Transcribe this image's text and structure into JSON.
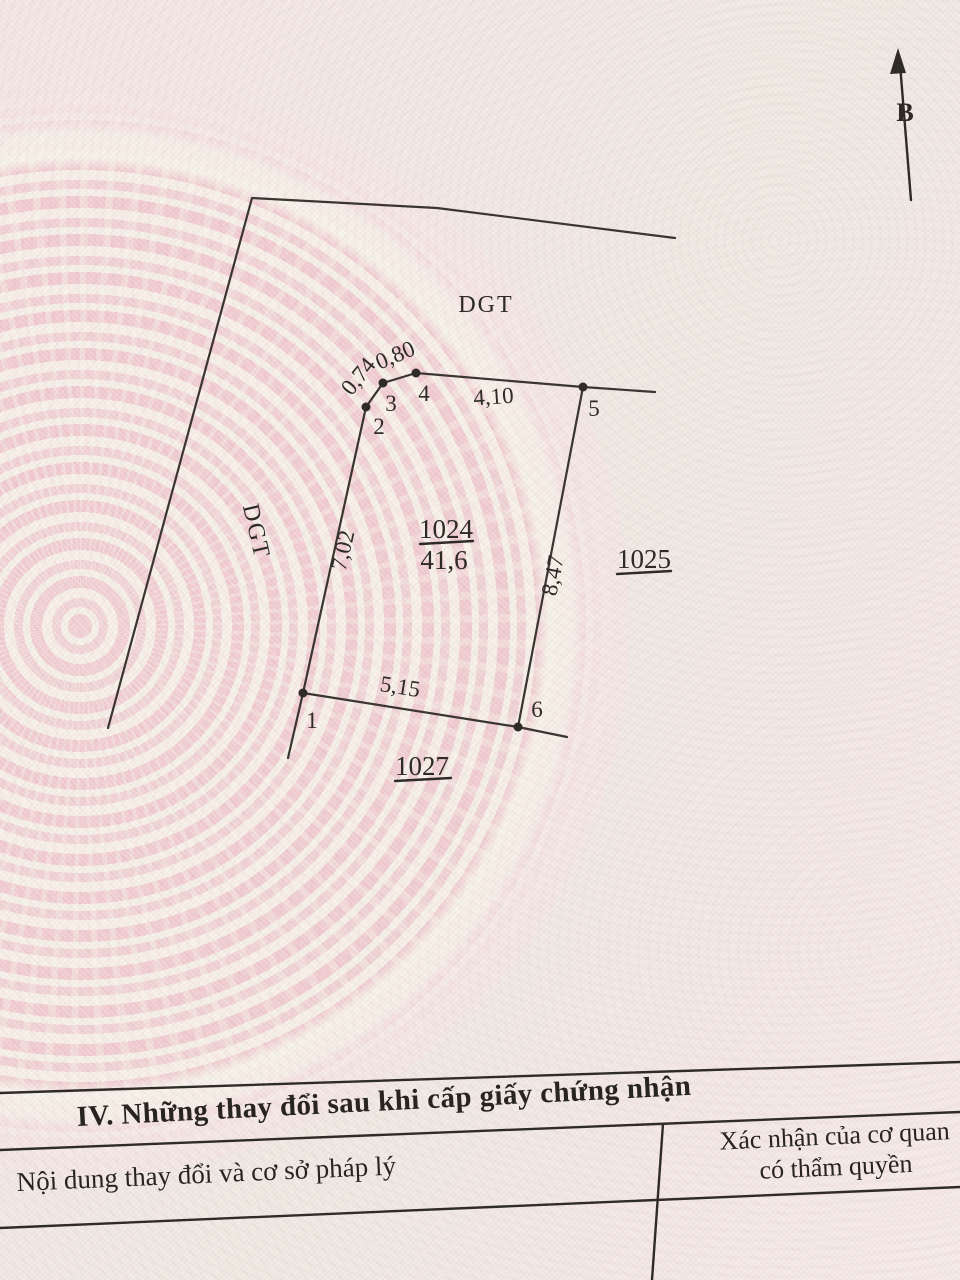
{
  "map": {
    "north_label": "B",
    "road_top_label": "DGT",
    "road_left_label": "DGT",
    "parcel": {
      "id": "1024",
      "area": "41,6"
    },
    "neighbor_right": "1025",
    "neighbor_bottom": "1027",
    "vertices": {
      "v1": "1",
      "v2": "2",
      "v3": "3",
      "v4": "4",
      "v5": "5",
      "v6": "6"
    },
    "edges": {
      "e12": "7,02",
      "e23": "0,74",
      "e34": "0,80",
      "e45": "4,10",
      "e56": "8,47",
      "e61": "5,15"
    }
  },
  "section": {
    "title": "IV. Những thay đổi sau khi cấp giấy chứng nhận",
    "columns": {
      "content": "Nội dung thay đổi và cơ sở pháp lý",
      "confirm_line1": "Xác nhận của cơ quan",
      "confirm_line2": "có thẩm quyền"
    }
  },
  "colors": {
    "paper": "#f1e5e2",
    "emblem_pink": "#eec0c7",
    "emblem_cream": "#f3f0e6",
    "ink": "#2e2a26"
  }
}
